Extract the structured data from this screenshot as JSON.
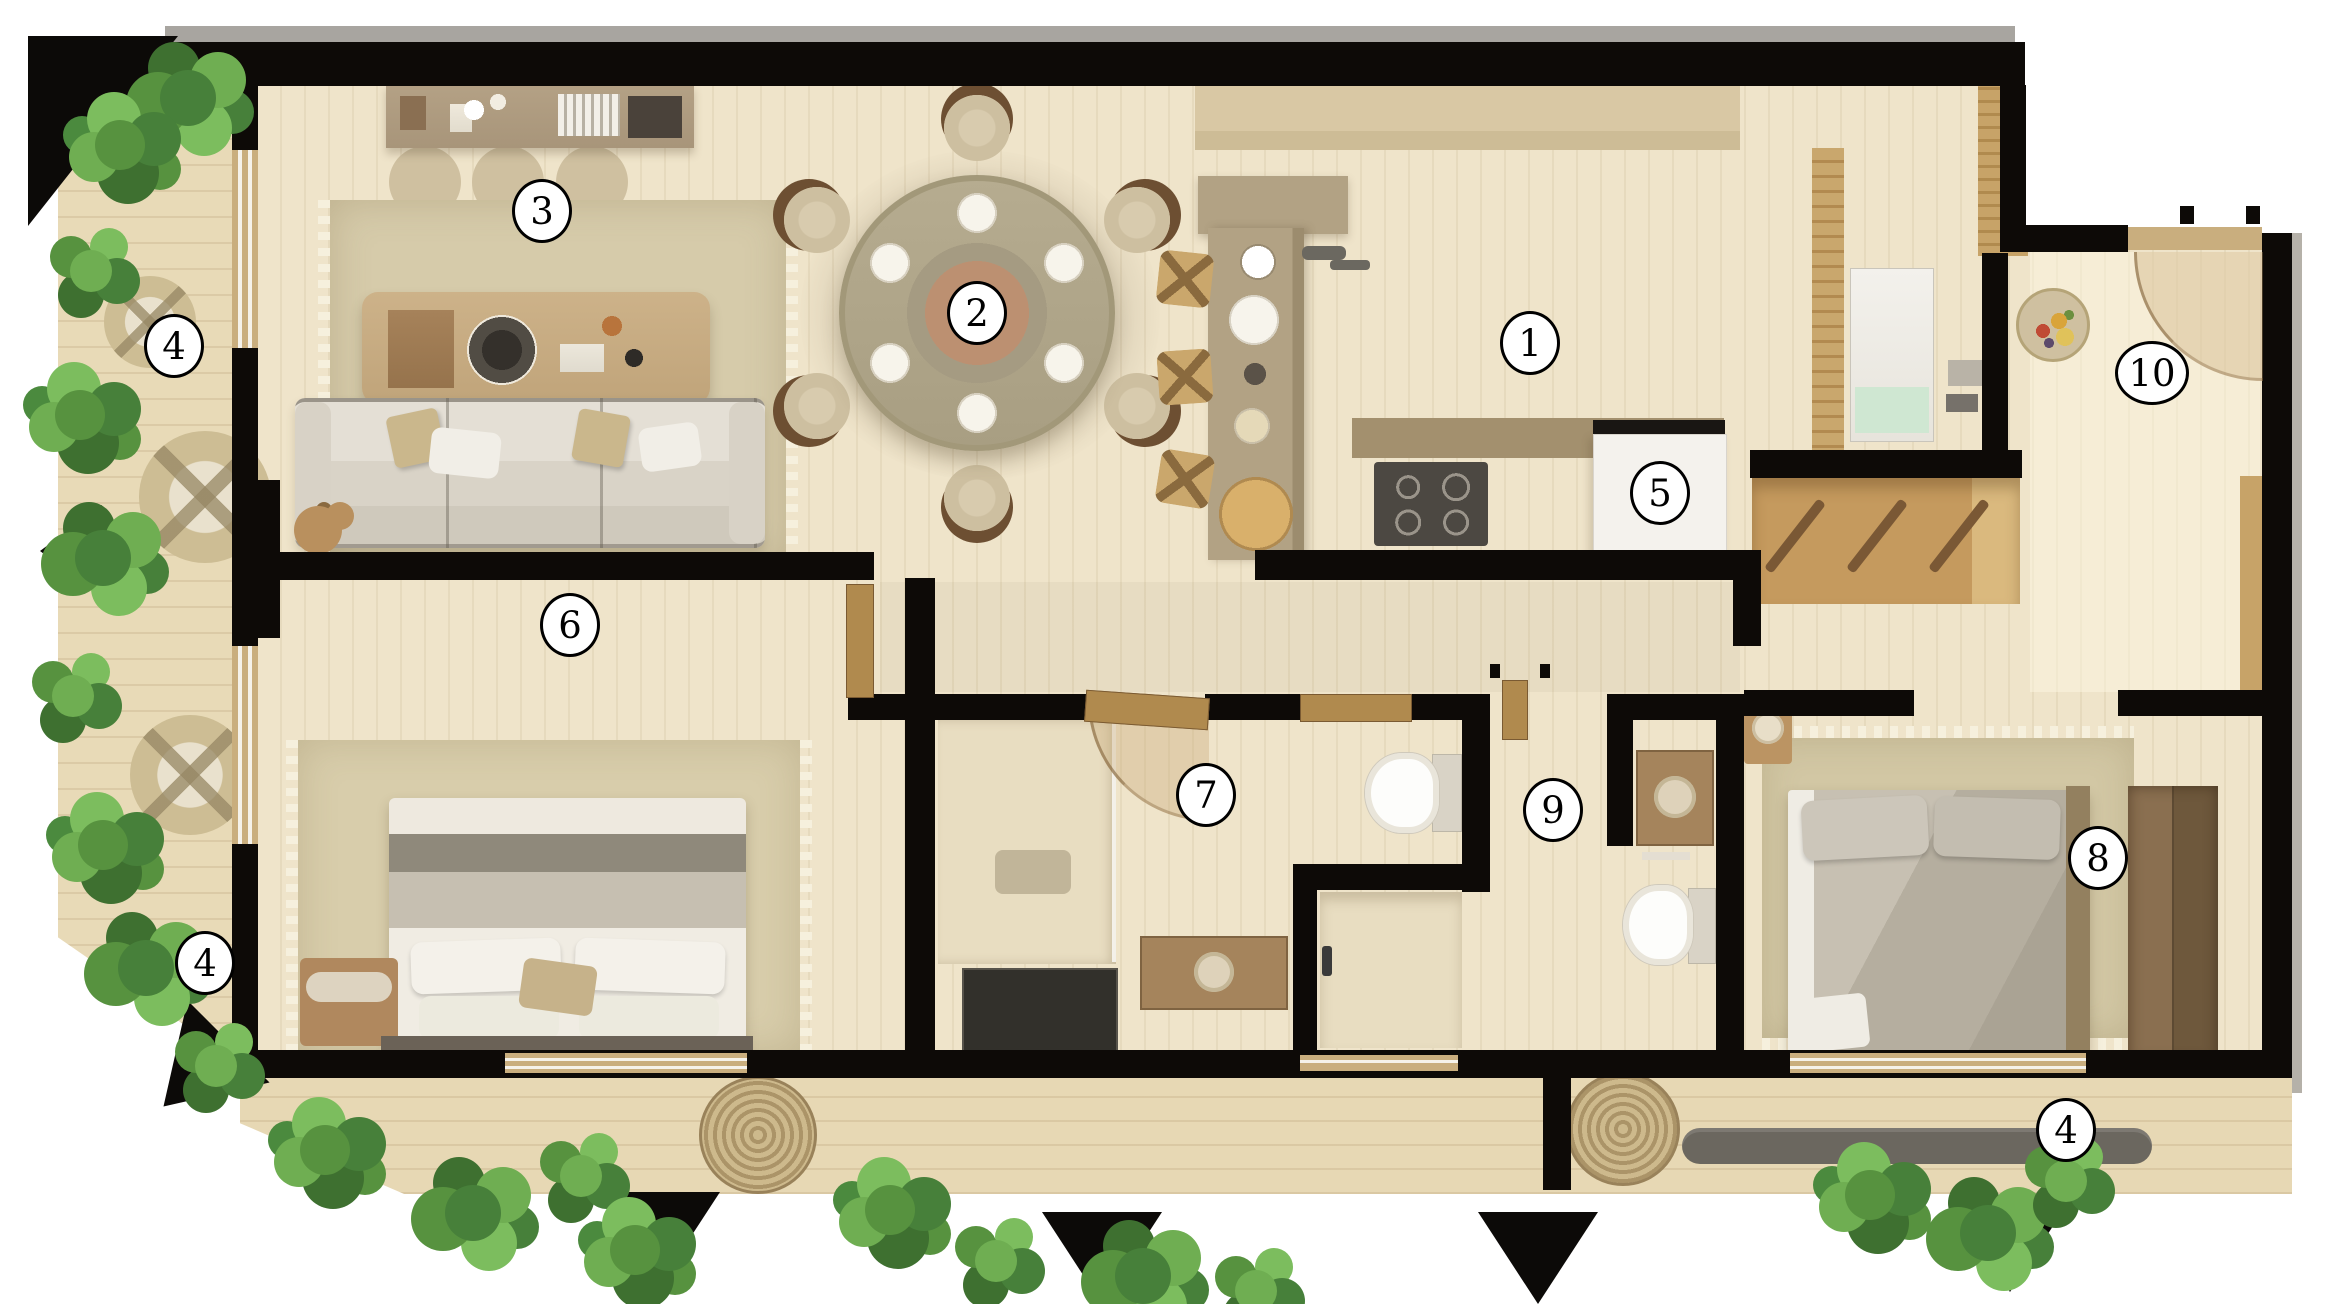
{
  "title": "Apartment floor plan — top-down furnished render",
  "labels": [
    {
      "number": "1",
      "area": "kitchen"
    },
    {
      "number": "2",
      "area": "dining-table"
    },
    {
      "number": "3",
      "area": "living-room"
    },
    {
      "number": "4",
      "area": "terrace-upper-left"
    },
    {
      "number": "4",
      "area": "terrace-lower-left"
    },
    {
      "number": "4",
      "area": "terrace-bottom-right"
    },
    {
      "number": "5",
      "area": "refrigerator"
    },
    {
      "number": "6",
      "area": "bedroom-1"
    },
    {
      "number": "7",
      "area": "hallway-dressing"
    },
    {
      "number": "8",
      "area": "bedroom-2"
    },
    {
      "number": "9",
      "area": "bathroom-hallway"
    },
    {
      "number": "10",
      "area": "entry-hall"
    }
  ],
  "colors": {
    "wall": "#0d0a07",
    "floor": "#efe4ca",
    "terrace": "#e8dab7",
    "rug": "#d6cbaa",
    "wood_accent": "#c59a5e",
    "plant_dark": "#3e7030",
    "plant_light": "#7cbd5e",
    "appliance_white": "#f4f2ed",
    "stove": "#4c4842",
    "laundry_green": "#cfe7d2"
  },
  "icons": [
    "sofa",
    "coffee-table",
    "wall-shelf",
    "pouf",
    "teddy-bear",
    "dining-table",
    "dining-chair",
    "plate",
    "kitchen-island",
    "bar-stool",
    "faucet",
    "stove",
    "refrigerator",
    "upper-cabinet",
    "washing-machine",
    "coat-hanger",
    "wardrobe",
    "bed",
    "pillow",
    "bench",
    "nightstand",
    "rug",
    "toilet",
    "shower",
    "vanity-sink",
    "glass-partition",
    "door-leaf",
    "door-swing",
    "window",
    "papasan-chair",
    "basket",
    "plant-hedge",
    "wall-art",
    "direction-arrow"
  ]
}
